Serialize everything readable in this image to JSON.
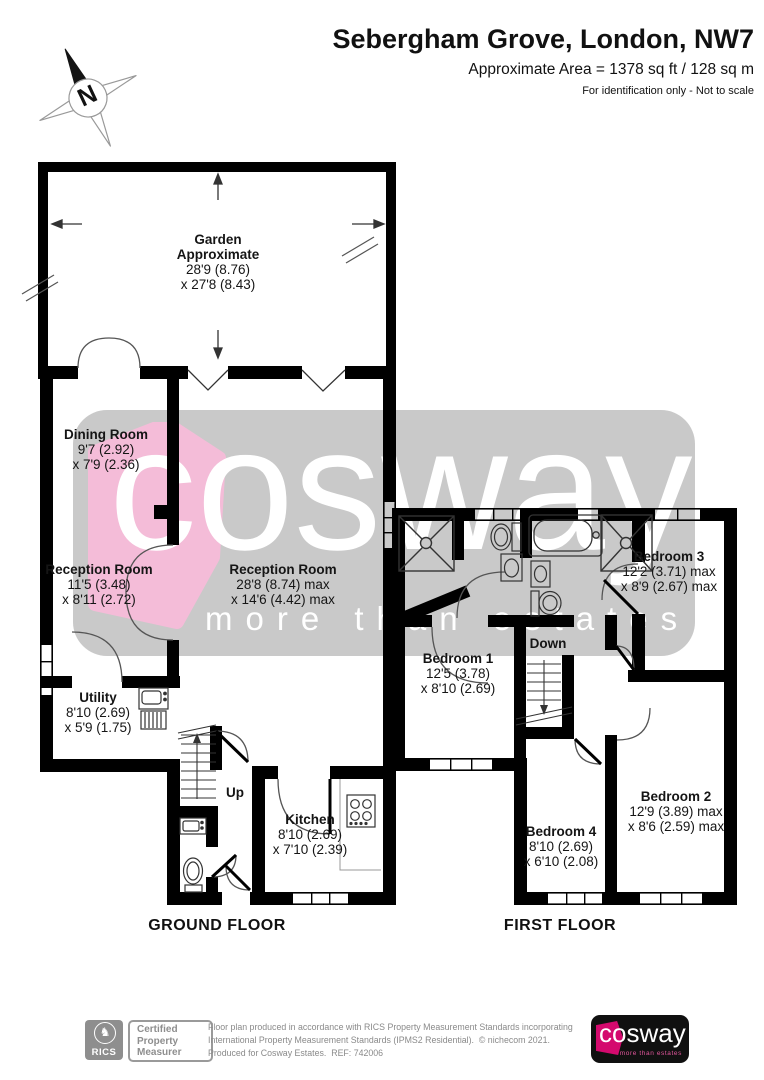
{
  "header": {
    "title": "Sebergham Grove, London, NW7",
    "area": "Approximate Area = 1378 sq ft / 128 sq m",
    "note": "For identification only - Not to scale"
  },
  "compass": {
    "label": "N"
  },
  "watermark": {
    "word": "cosway",
    "tagline": "more than estates",
    "gray": "#c9c9c9",
    "pink": "#f4bcd8"
  },
  "ground_floor": {
    "title": "GROUND FLOOR",
    "stairs_label": "Up",
    "rooms": {
      "garden": {
        "name": "Garden",
        "name2": "Approximate",
        "dim1": "28'9 (8.76)",
        "dim2": "x 27'8 (8.43)"
      },
      "dining": {
        "name": "Dining Room",
        "dim1": "9'7 (2.92)",
        "dim2": "x 7'9 (2.36)"
      },
      "reception_small": {
        "name": "Reception Room",
        "dim1": "11'5 (3.48)",
        "dim2": "x 8'11 (2.72)"
      },
      "reception_large": {
        "name": "Reception Room",
        "dim1": "28'8 (8.74) max",
        "dim2": "x 14'6 (4.42) max"
      },
      "utility": {
        "name": "Utility",
        "dim1": "8'10 (2.69)",
        "dim2": "x 5'9 (1.75)"
      },
      "kitchen": {
        "name": "Kitchen",
        "dim1": "8'10 (2.69)",
        "dim2": "x 7'10 (2.39)"
      }
    }
  },
  "first_floor": {
    "title": "FIRST FLOOR",
    "stairs_label": "Down",
    "rooms": {
      "bedroom1": {
        "name": "Bedroom 1",
        "dim1": "12'5 (3.78)",
        "dim2": "x 8'10 (2.69)"
      },
      "bedroom2": {
        "name": "Bedroom 2",
        "dim1": "12'9 (3.89) max",
        "dim2": "x 8'6 (2.59) max"
      },
      "bedroom3": {
        "name": "Bedroom 3",
        "dim1": "12'2 (3.71) max",
        "dim2": "x 8'9 (2.67) max"
      },
      "bedroom4": {
        "name": "Bedroom 4",
        "dim1": "8'10 (2.69)",
        "dim2": "x 6'10 (2.08)"
      }
    }
  },
  "footer": {
    "rics": "RICS",
    "rics_crest": "♞",
    "certification": {
      "line1": "Certified",
      "line2": "Property",
      "line3": "Measurer"
    },
    "disclaimer_line1": "Floor plan produced in accordance with RICS Property Measurement Standards incorporating",
    "disclaimer_line2": "International Property Measurement Standards (IPMS2 Residential).  © nichecom 2021.",
    "disclaimer_line3": "Produced for Cosway Estates.  REF: 742006",
    "logo": {
      "word": "cosway",
      "tagline": "more than estates"
    }
  }
}
